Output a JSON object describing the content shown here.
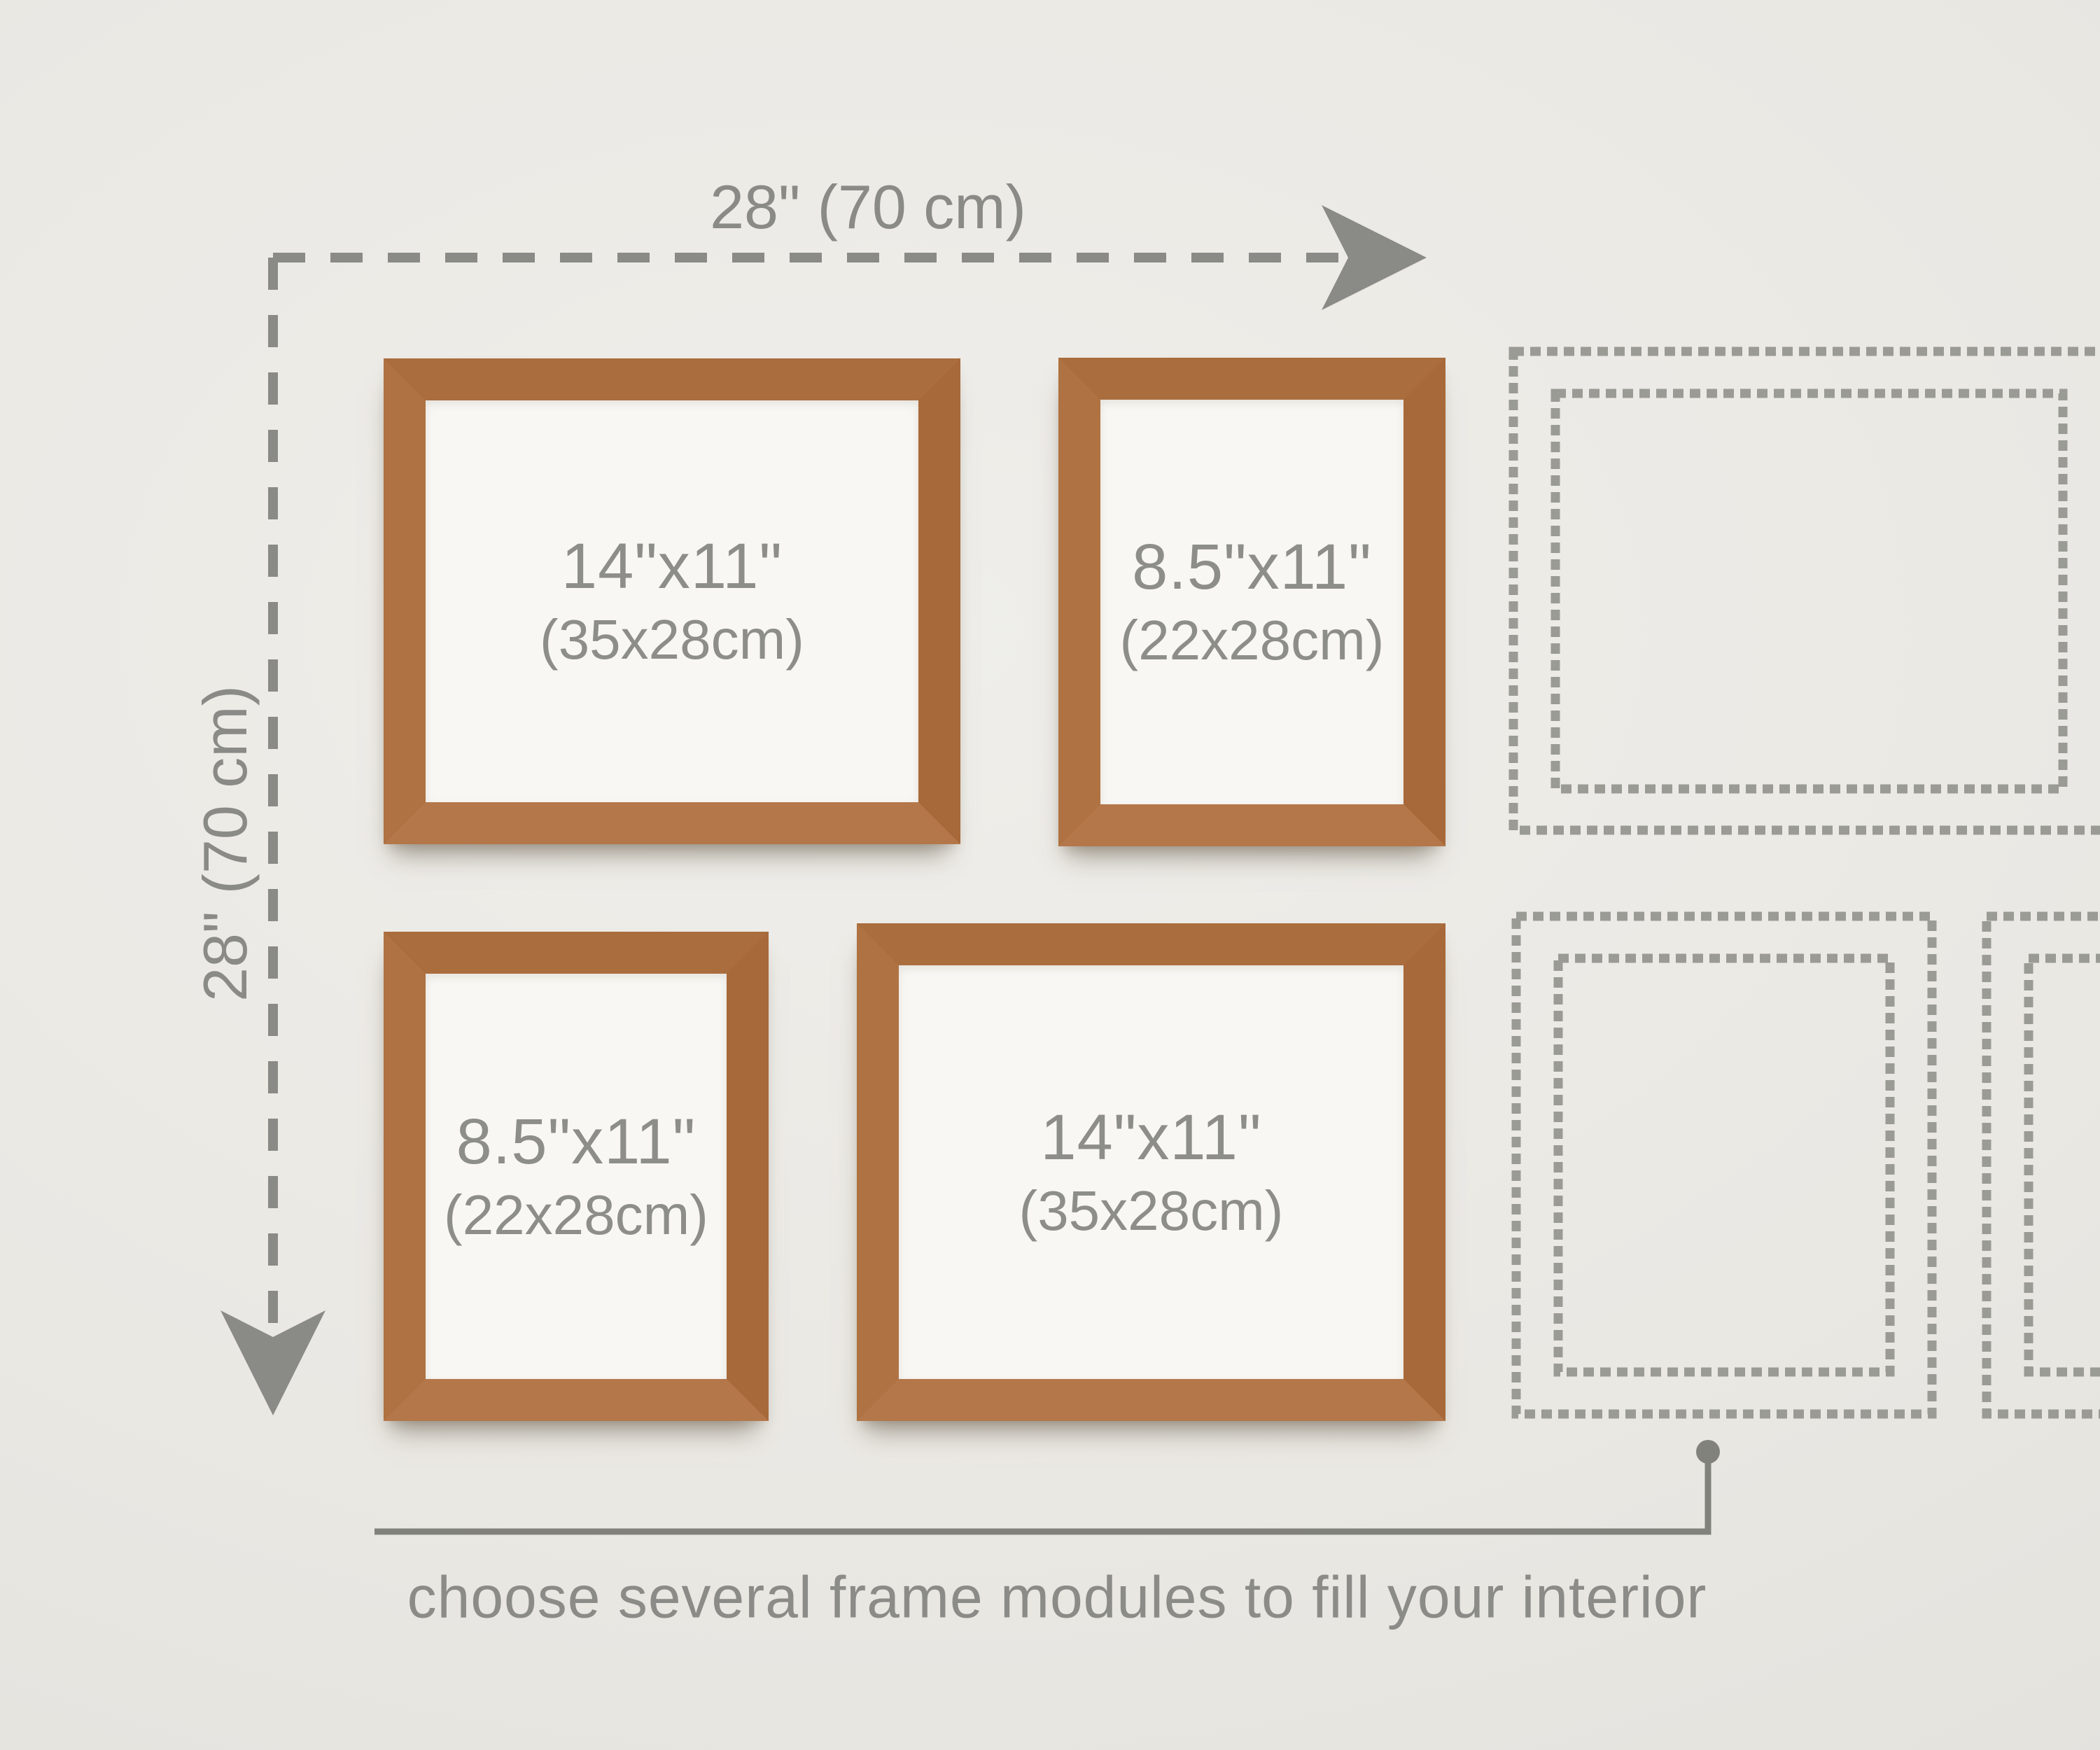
{
  "scene": {
    "type": "gallery-wall-frame-size-diagram",
    "wall_color": "#eae8e3",
    "caption": "choose several frame modules to fill your interior"
  },
  "dimension_arrows": {
    "horizontal": {
      "label": "28\" (70 cm)",
      "direction": "right"
    },
    "vertical": {
      "label": "28\" (70 cm)",
      "direction": "down"
    }
  },
  "frames": [
    {
      "position": "top-left",
      "orientation": "landscape",
      "size_in": "14\"x11\"",
      "size_cm": "(35x28cm)"
    },
    {
      "position": "top-right",
      "orientation": "portrait",
      "size_in": "8.5\"x11\"",
      "size_cm": "(22x28cm)"
    },
    {
      "position": "bottom-left",
      "orientation": "portrait",
      "size_in": "8.5\"x11\"",
      "size_cm": "(22x28cm)"
    },
    {
      "position": "bottom-right",
      "orientation": "landscape",
      "size_in": "14\"x11\"",
      "size_cm": "(35x28cm)"
    }
  ],
  "placeholder_frames": [
    {
      "position": "right-top",
      "style": "double-dashed-outline",
      "orientation": "landscape",
      "clipped_right": true
    },
    {
      "position": "right-bottom",
      "style": "double-dashed-outline",
      "orientation": "portrait",
      "clipped_right": false
    },
    {
      "position": "right-bottom-partial",
      "style": "double-dashed-outline",
      "orientation": "portrait",
      "clipped_right": true
    }
  ],
  "callout": {
    "shape": "line-with-dot",
    "points_to": "placeholder-frames"
  },
  "colors": {
    "wood_top": "#aa6d3d",
    "wood_right": "#a76939",
    "wood_bottom": "#b4774a",
    "wood_left": "#af7242",
    "frame_paper": "#f8f7f3",
    "label_gray": "#8d8d89",
    "dimension_gray": "#8a8a86",
    "placeholder_dash_gray": "#9b9b96",
    "callout_gray": "#82827d"
  }
}
